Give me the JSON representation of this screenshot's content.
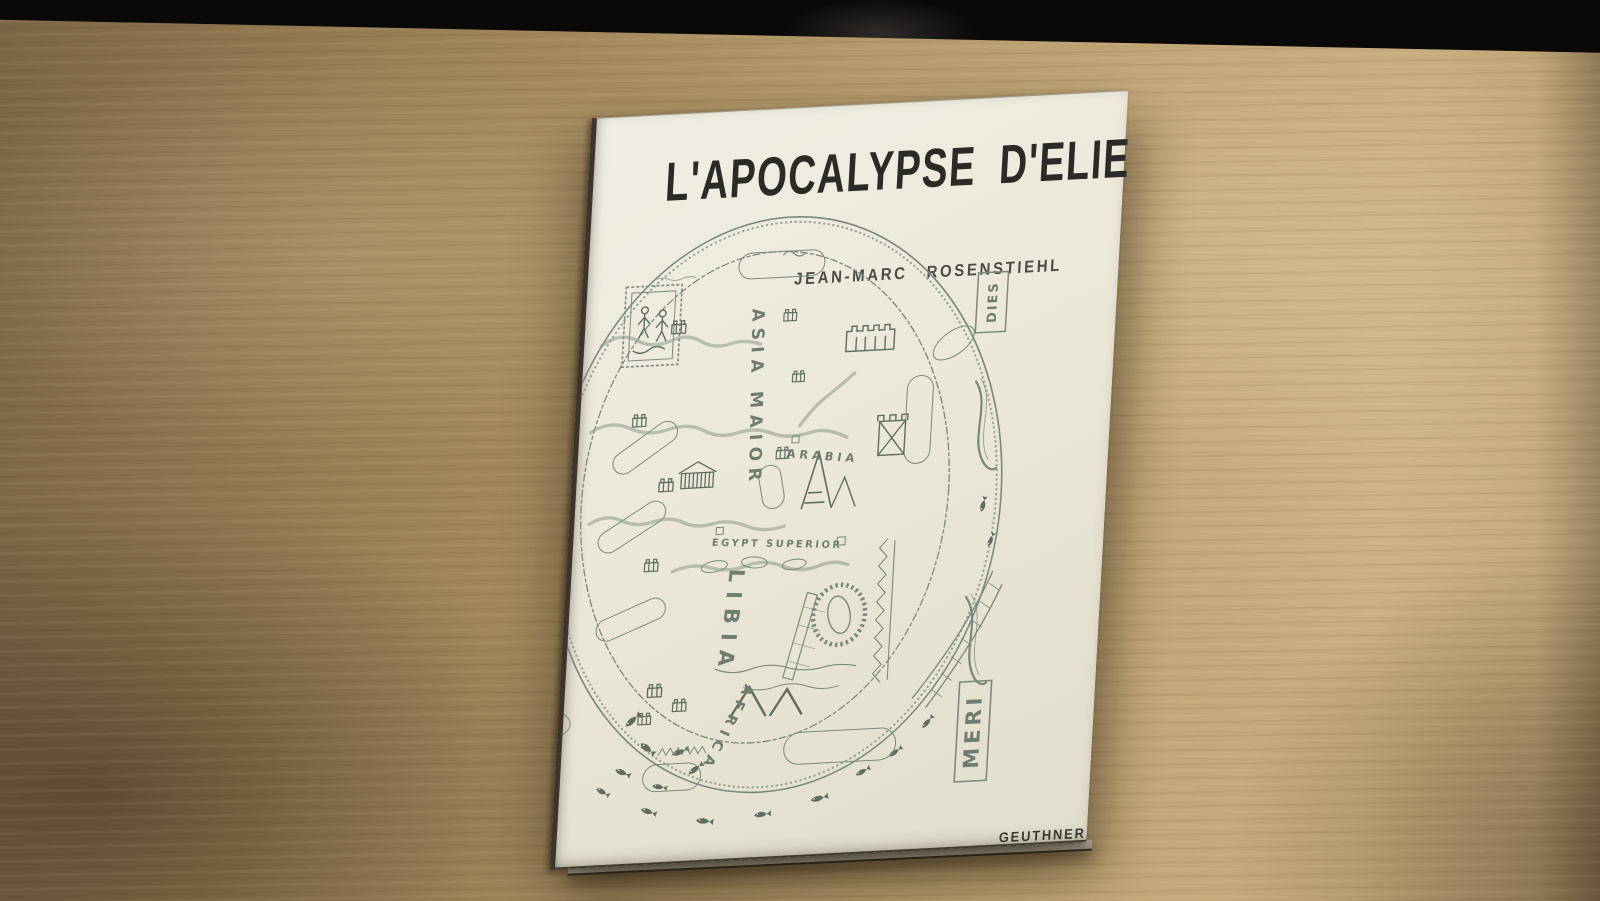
{
  "colors": {
    "backdrop": "#0b0908",
    "wood_light": "#c8ad7e",
    "wood_dark": "#7c6546",
    "cover_paper": "#ece9db",
    "map_ink": "#7a897c",
    "title_ink": "#2b2a25"
  },
  "book": {
    "title": "L'APOCALYPSE D'ELIE",
    "author": "JEAN-MARC ROSENSTIEHL",
    "publisher": "GEUTHNER"
  },
  "map_labels": {
    "asia_maior": "ASIA MAIOR",
    "arabia": "ARABIA",
    "egypt_superior": "EGYPT SUPERIOR",
    "libia": "LIBIA",
    "africa": "AFRICA",
    "meridies_upper": "DIES",
    "meridies_lower": "MERI"
  }
}
